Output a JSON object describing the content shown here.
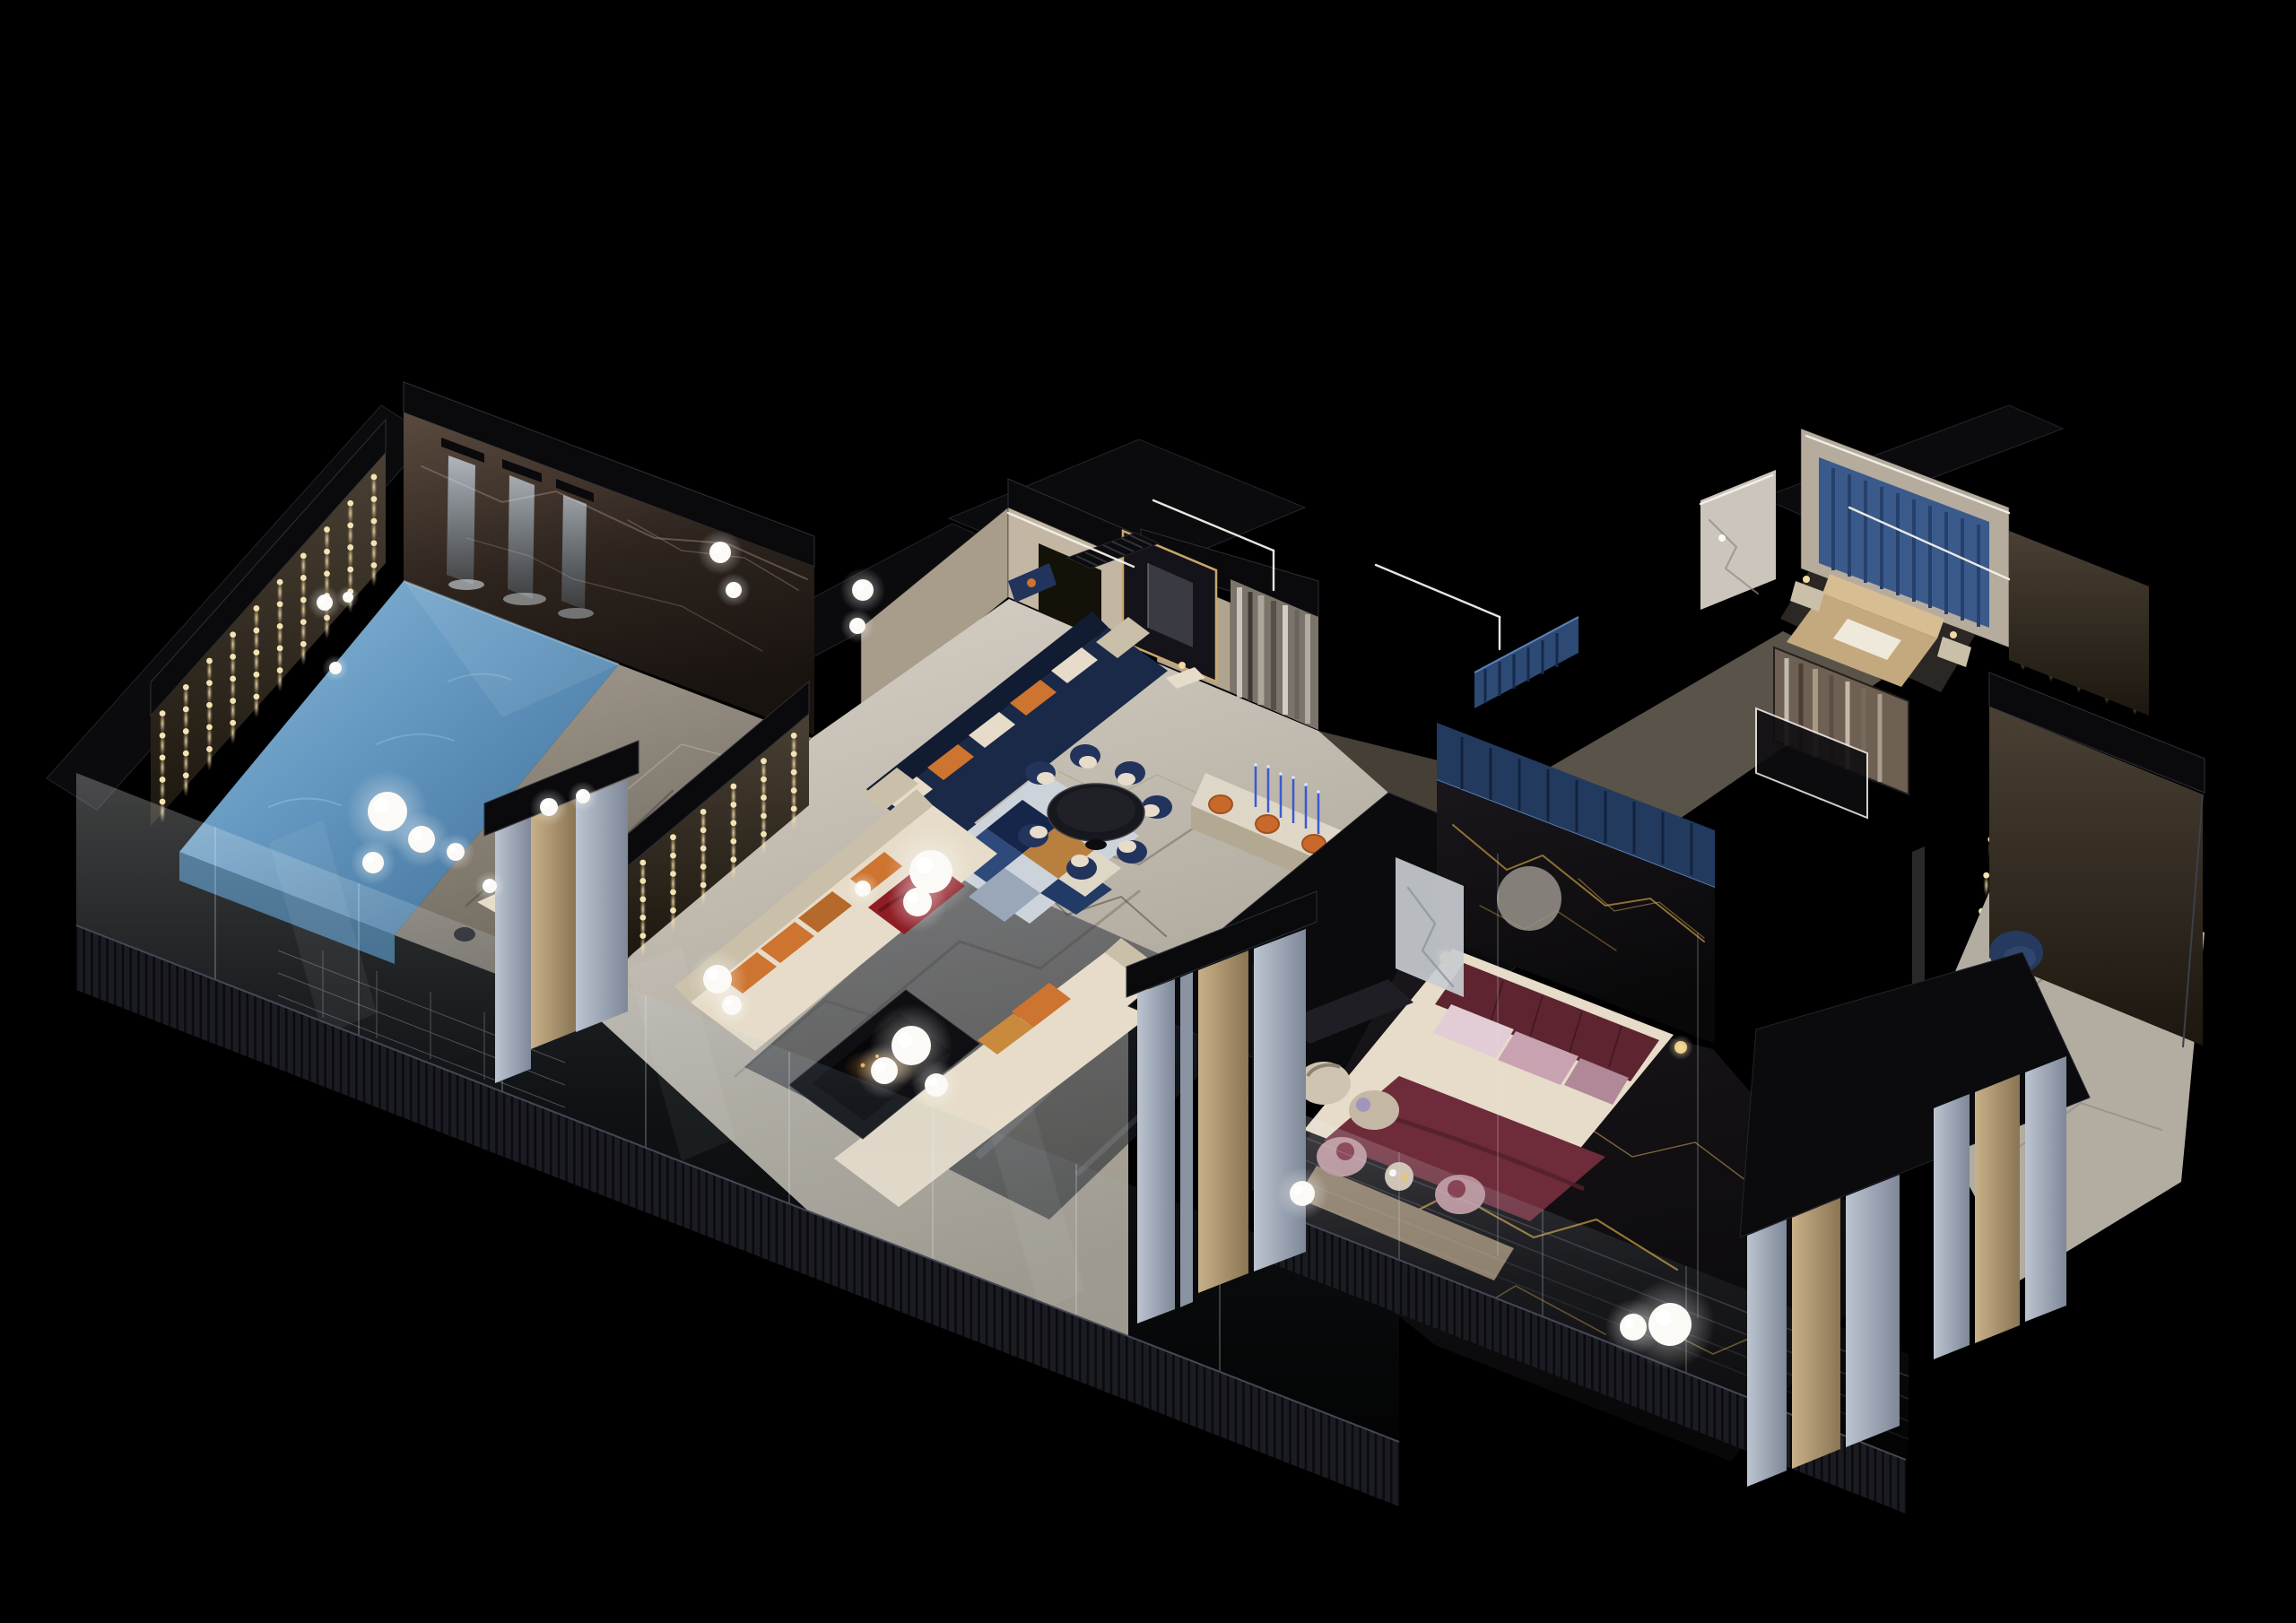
{
  "scene": {
    "description": "Night-time axonometric cutaway 3D render of a luxury penthouse floor plan glowing against a pure black background",
    "view": "isometric cutaway seen from the front-left, roof removed",
    "time_of_day": "night"
  },
  "palette": {
    "background": "#000000",
    "pool_water": "#6397c0",
    "pool_water_light": "#8fbad8",
    "pool_water_deep": "#3c6b93",
    "marble_brown": "#4a3b31",
    "marble_light": "#cfc9bf",
    "marble_black": "#0d0c0e",
    "gold_vein": "#c49a42",
    "cream": "#e6dcc9",
    "cream_shade": "#cabfa8",
    "orange": "#cd7430",
    "red_throw": "#8f1d25",
    "navy": "#22335c",
    "navy_deep": "#1a2947",
    "burgundy": "#5e2531",
    "duvet_burgundy": "#6e2c3a",
    "pillow_mauve": "#c9a2b2",
    "pillow_mauve_light": "#e2ccd6",
    "mauve_chair": "#b78e96",
    "bed_tan": "#c4a97e",
    "steel_column": "#aab4c4",
    "tan_column": "#c2ab80",
    "louver": "#1b1c21",
    "beige_wall": "#c3b7a4",
    "art_light": "#d8d2c8",
    "art_dark": "#3e3832",
    "blue_panel": "#3a5a8c",
    "closet_blue": "#2c4a74",
    "candle_blue": "#3a5ad0",
    "stool_orange": "#c8692b",
    "uplight_warm": "#f4e3b2",
    "cove_white": "#f4f2ea",
    "lamp_white": "#fbfaf6",
    "fire_gold": "#e8a84a"
  },
  "rooms": [
    {
      "id": "pool-terrace",
      "label": "Indoor pool terrace with waterfall feature wall"
    },
    {
      "id": "pool",
      "label": "Rectangular swimming pool with glass infinity edge"
    },
    {
      "id": "pool-deck",
      "label": "Marble pool deck with chaise and globe lamps"
    },
    {
      "id": "living-room",
      "label": "Living room with facing cream sofas and black fire table"
    },
    {
      "id": "family-lounge",
      "label": "Family lounge with navy sectional and geometric rug"
    },
    {
      "id": "dining-room",
      "label": "Dining area with round black table and six navy chairs"
    },
    {
      "id": "bar",
      "label": "Bar counter with orange stools and blue taper candles"
    },
    {
      "id": "hallway",
      "label": "Gallery hallway with brushed abstract art wall"
    },
    {
      "id": "elevator-lobby",
      "label": "Elevator portal with brass trim"
    },
    {
      "id": "master-bedroom",
      "label": "Master bedroom with black-gold marble and burgundy bed"
    },
    {
      "id": "walk-in-closet",
      "label": "Wardrobe with blue back-lit hanging rail"
    },
    {
      "id": "guest-bedroom",
      "label": "Guest bedroom with blue slatted headboard wall"
    },
    {
      "id": "reading-lounge",
      "label": "Reading corner with candle-lit feature wall and navy armchair"
    },
    {
      "id": "facade",
      "label": "Cut-away facade: fluted steel and brass columns, dark louver band, glass balustrade"
    }
  ],
  "lights": {
    "dot_color": "#f4e3b2",
    "uplight_walls": [
      {
        "name": "pool-flank-wall",
        "corners": [
          [
            168,
            798
          ],
          [
            430,
            505
          ],
          [
            430,
            628
          ],
          [
            168,
            921
          ]
        ],
        "rows": 5,
        "cols": 10
      },
      {
        "name": "living-flank-wall",
        "corners": [
          [
            700,
            966
          ],
          [
            902,
            796
          ],
          [
            902,
            898
          ],
          [
            700,
            1068
          ]
        ],
        "rows": 5,
        "cols": 6
      },
      {
        "name": "reading-wall",
        "corners": [
          [
            2218,
            788
          ],
          [
            2456,
            886
          ],
          [
            2420,
            1166
          ],
          [
            2182,
            1068
          ]
        ],
        "rows": 7,
        "cols": 6
      },
      {
        "name": "upper-right-wall",
        "corners": [
          [
            2240,
            592
          ],
          [
            2396,
            654
          ],
          [
            2396,
            798
          ],
          [
            2240,
            736
          ]
        ],
        "rows": 4,
        "cols": 5
      }
    ],
    "louver_bands": [
      {
        "name": "front-band-main",
        "corners": [
          [
            85,
            1032
          ],
          [
            1560,
            1608
          ],
          [
            1560,
            1680
          ],
          [
            85,
            1104
          ]
        ],
        "slats": 170
      },
      {
        "name": "front-band-bedroom",
        "corners": [
          [
            1400,
            1342
          ],
          [
            2125,
            1628
          ],
          [
            2125,
            1688
          ],
          [
            1400,
            1402
          ]
        ],
        "slats": 85
      }
    ],
    "sphere_lamps": [
      [
        432,
        905,
        22
      ],
      [
        470,
        936,
        15
      ],
      [
        416,
        962,
        12
      ],
      [
        508,
        950,
        10
      ],
      [
        546,
        988,
        8
      ],
      [
        612,
        900,
        10
      ],
      [
        650,
        888,
        8
      ],
      [
        362,
        672,
        9
      ],
      [
        388,
        666,
        6
      ],
      [
        374,
        745,
        7
      ],
      [
        803,
        616,
        12
      ],
      [
        818,
        658,
        9
      ],
      [
        1038,
        972,
        24
      ],
      [
        1023,
        1006,
        16
      ],
      [
        962,
        991,
        9
      ],
      [
        800,
        1092,
        16
      ],
      [
        816,
        1121,
        11
      ],
      [
        1016,
        1166,
        22
      ],
      [
        986,
        1194,
        15
      ],
      [
        1044,
        1210,
        13
      ],
      [
        962,
        658,
        12
      ],
      [
        956,
        698,
        9
      ],
      [
        1862,
        1477,
        24
      ],
      [
        1821,
        1480,
        15
      ],
      [
        1452,
        1331,
        14
      ]
    ],
    "cove_lines": [
      [
        1286,
        558,
        1420,
        614
      ],
      [
        1420,
        614,
        1420,
        658
      ],
      [
        1534,
        630,
        1672,
        688
      ],
      [
        1672,
        688,
        1672,
        724
      ],
      [
        2014,
        486,
        2240,
        572
      ],
      [
        1124,
        572,
        1264,
        632
      ],
      [
        1896,
        562,
        1976,
        530
      ],
      [
        2062,
        566,
        2240,
        646
      ]
    ]
  }
}
